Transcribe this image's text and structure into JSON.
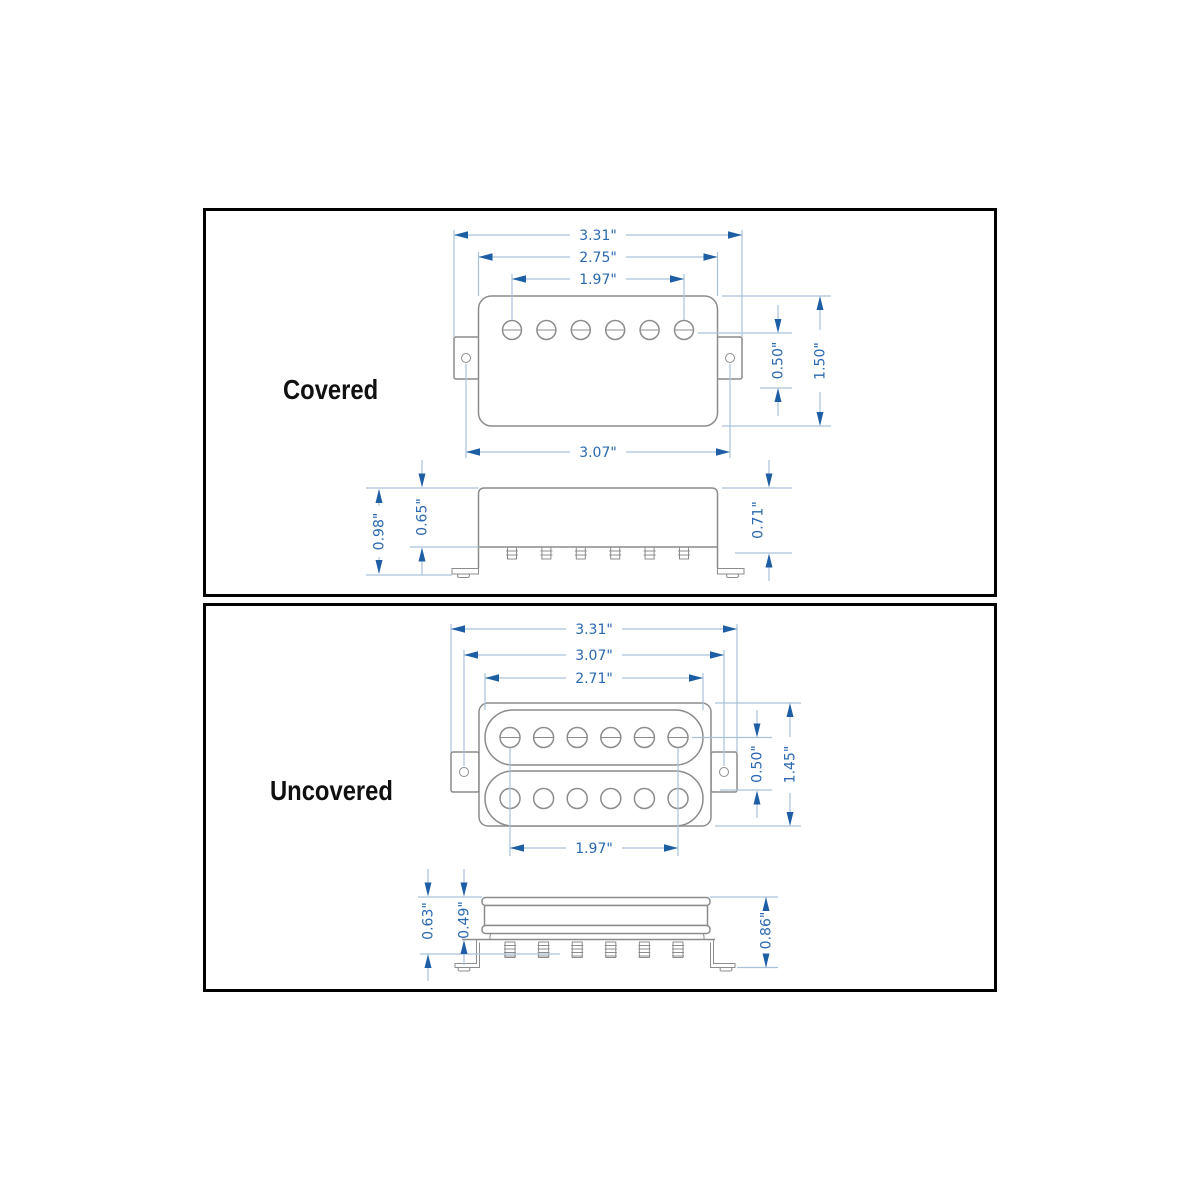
{
  "panels": [
    {
      "label": "Covered",
      "dims": {
        "overall_width": "3.31\"",
        "cover_width": "2.75\"",
        "pole_spacing": "1.97\"",
        "mount_spacing": "3.07\"",
        "pole_offset": "0.50\"",
        "body_height": "1.50\"",
        "total_depth": "0.98\"",
        "cover_depth": "0.65\"",
        "base_depth": "0.71\""
      }
    },
    {
      "label": "Uncovered",
      "dims": {
        "overall_width": "3.31\"",
        "mount_spacing": "3.07\"",
        "bobbin_width": "2.71\"",
        "pole_spacing": "1.97\"",
        "pole_offset": "0.50\"",
        "body_height": "1.45\"",
        "total_depth": "0.63\"",
        "bobbin_depth": "0.49\"",
        "base_depth": "0.86\""
      }
    }
  ],
  "colors": {
    "dimension_text": "#2a68b0",
    "dimension_line": "#a9c2da",
    "arrowhead": "#1e5ea4",
    "drawing_outline": "#8c8c8c",
    "label_text": "#101010",
    "panel_border": "#000000"
  }
}
